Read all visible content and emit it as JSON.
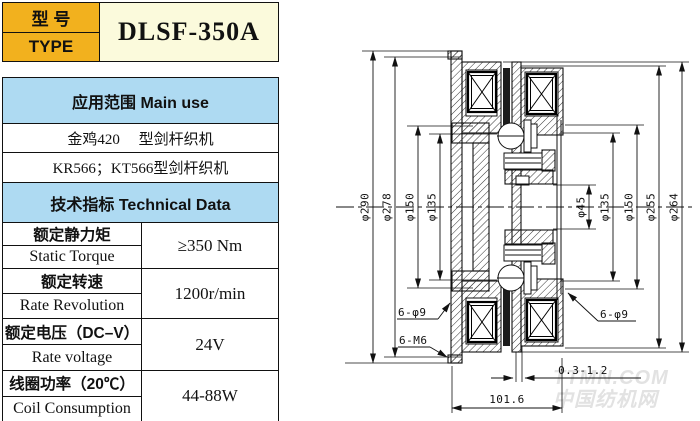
{
  "model": {
    "label_cn": "型 号",
    "label_en": "TYPE",
    "value": "DLSF-350A"
  },
  "main_use": {
    "header": "应用范围  Main use",
    "rows": [
      "金鸡420　 型剑杆织机",
      "KR566；KT566型剑杆织机"
    ]
  },
  "tech": {
    "header": "技术指标  Technical Data",
    "rows": [
      {
        "cn": "额定静力矩",
        "en": "Static Torque",
        "value": "≥350 Nm"
      },
      {
        "cn": "额定转速",
        "en": "Rate Revolution",
        "value": "1200r/min"
      },
      {
        "cn": "额定电压（DC–V）",
        "en": "Rate voltage",
        "value": "24V"
      },
      {
        "cn": "线圈功率（20℃）",
        "en": "Coil Consumption",
        "value": "44-88W"
      }
    ]
  },
  "drawing": {
    "dia_labels": [
      "φ290",
      "φ278",
      "φ150",
      "φ135",
      "φ45",
      "φ135",
      "φ150",
      "φ255",
      "φ264"
    ],
    "hole_left": "6-φ9",
    "thread_left": "6-M6",
    "hole_right": "6-φ9",
    "gap": "0.3-1.2",
    "width": "101.6"
  },
  "watermark": {
    "line1": "TTMN.COM",
    "line2": "中国纺机网"
  },
  "colors": {
    "gold": "#F2B11E",
    "cream": "#FBFADC",
    "blue": "#AEDAF2",
    "line": "#111111"
  }
}
